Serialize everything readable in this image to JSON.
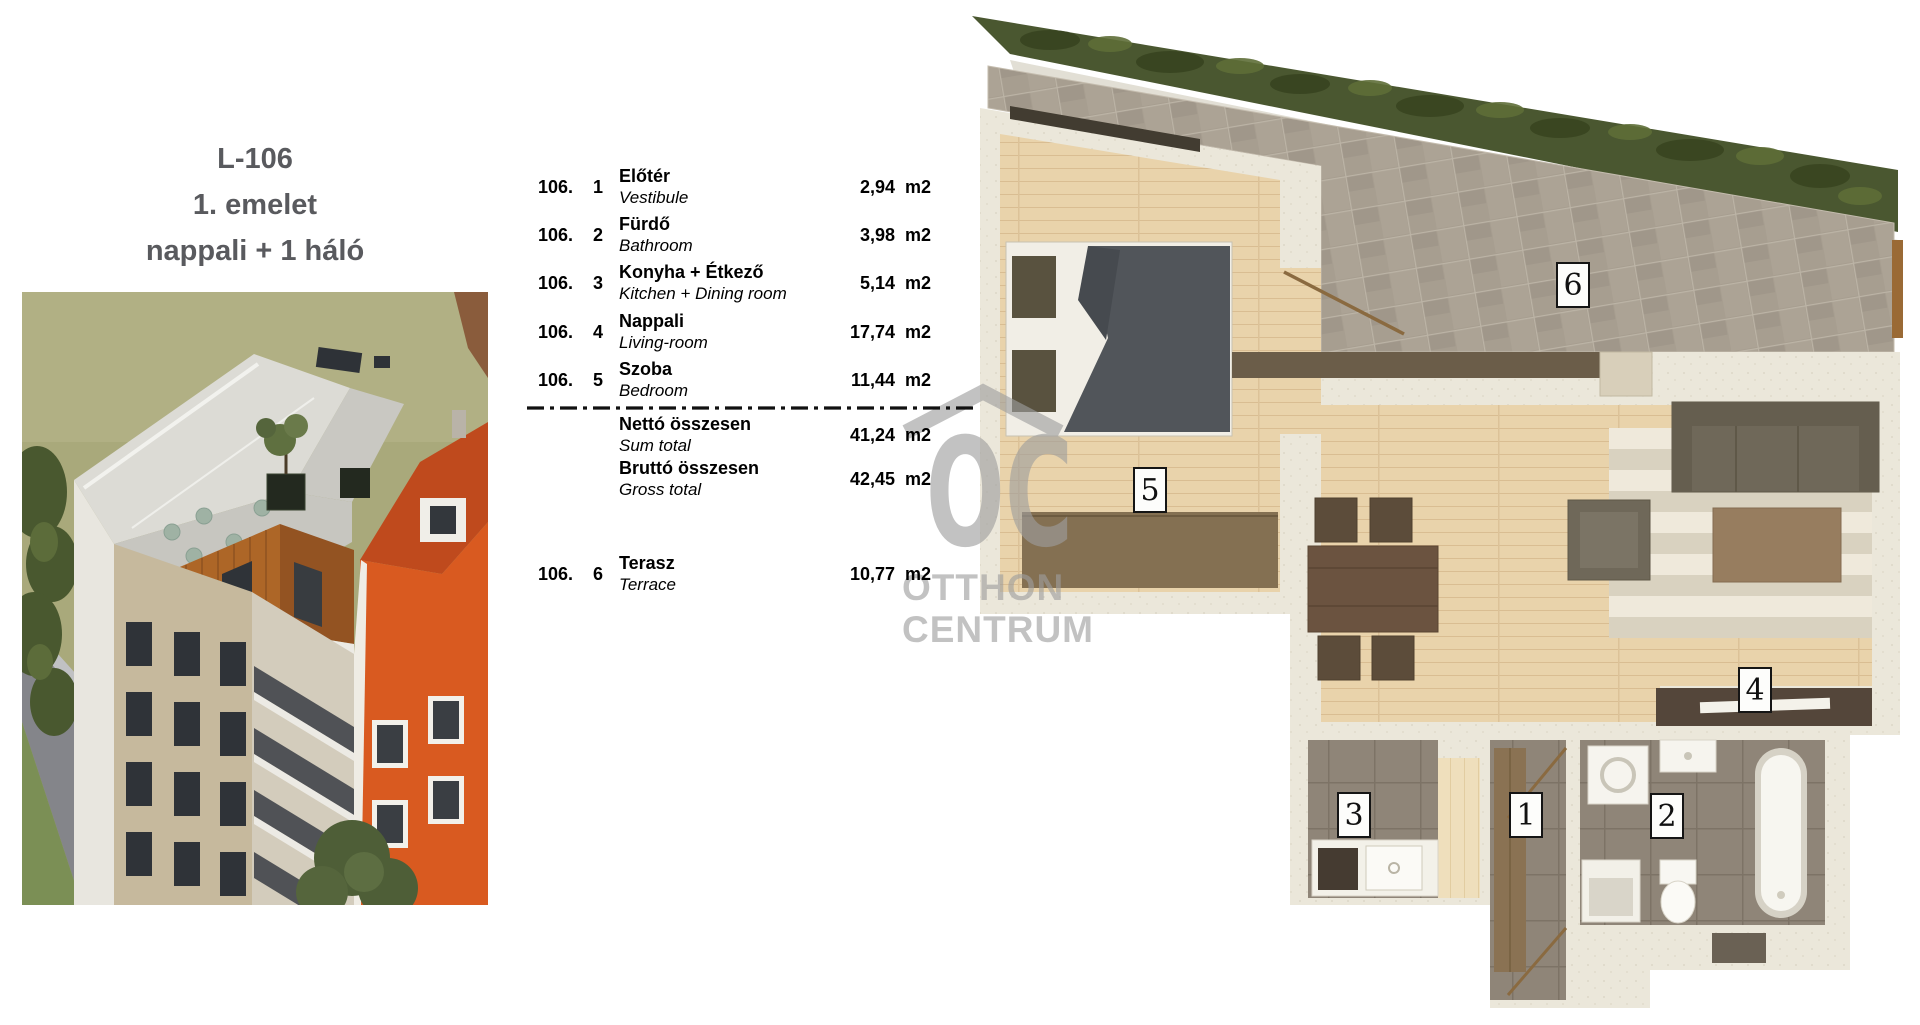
{
  "document": {
    "title_code": "L-106",
    "floor": "1. emelet",
    "layout": "nappali + 1 háló"
  },
  "watermark": {
    "logo": "OC",
    "line1": "OTTHON",
    "line2": "CENTRUM",
    "color": "#a9a9a9"
  },
  "area_table": {
    "unit": "m2",
    "rows": [
      {
        "apt": "106.",
        "num": "1",
        "label_hu": "Előtér",
        "label_en": "Vestibule",
        "value": "2,94"
      },
      {
        "apt": "106.",
        "num": "2",
        "label_hu": "Fürdő",
        "label_en": "Bathroom",
        "value": "3,98"
      },
      {
        "apt": "106.",
        "num": "3",
        "label_hu": "Konyha + Étkező",
        "label_en": "Kitchen + Dining room",
        "value": "5,14"
      },
      {
        "apt": "106.",
        "num": "4",
        "label_hu": "Nappali",
        "label_en": "Living-room",
        "value": "17,74"
      },
      {
        "apt": "106.",
        "num": "5",
        "label_hu": "Szoba",
        "label_en": "Bedroom",
        "value": "11,44"
      }
    ],
    "totals": [
      {
        "label_hu": "Nettó összesen",
        "label_en": "Sum total",
        "value": "41,24"
      },
      {
        "label_hu": "Bruttó összesen",
        "label_en": "Gross total",
        "value": "42,45"
      }
    ],
    "terrace_row": {
      "apt": "106.",
      "num": "6",
      "label_hu": "Terasz",
      "label_en": "Terrace",
      "value": "10,77"
    }
  },
  "floor_plan": {
    "room_labels": [
      {
        "number": "1"
      },
      {
        "number": "2"
      },
      {
        "number": "3"
      },
      {
        "number": "4"
      },
      {
        "number": "5"
      },
      {
        "number": "6"
      }
    ],
    "colors": {
      "wall": "#ebe7da",
      "wood_floor": "#e9d3ab",
      "dark_tile": "#8f8578",
      "terrace_tile": "#a79e90",
      "hedge_green": "#4a5730",
      "accent_orange": "#d95a20"
    }
  }
}
